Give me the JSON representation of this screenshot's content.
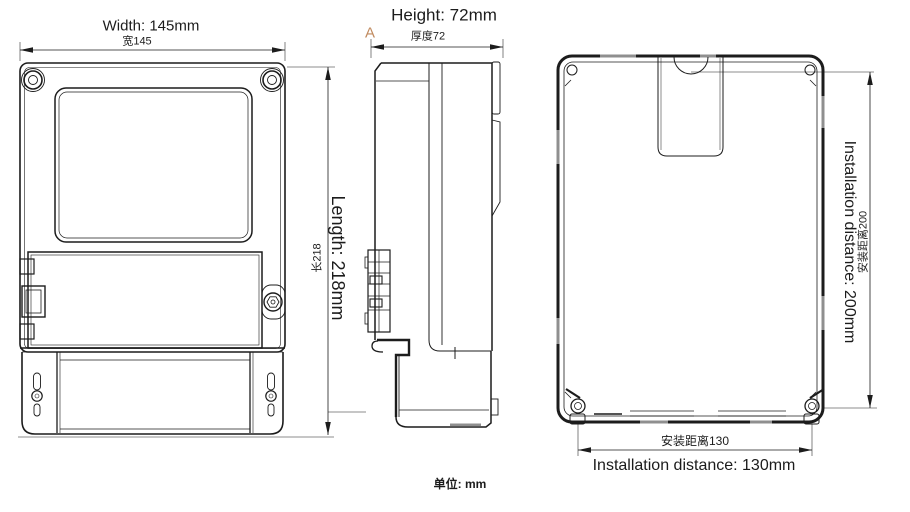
{
  "drawing": {
    "unit_note": "单位: mm",
    "front_view": {
      "width_dim_en": "Width: 145mm",
      "width_dim_cn": "宽145"
    },
    "side_view": {
      "height_dim_en": "Height: 72mm",
      "height_dim_cn": "厚度72",
      "length_dim_en": "Length: 218mm",
      "length_dim_cn": "长218",
      "section_marker": "A"
    },
    "back_view": {
      "vertical_dim_en": "Installation distance: 200mm",
      "vertical_dim_cn": "安装距离200",
      "horizontal_dim_en": "Installation distance: 130mm",
      "horizontal_dim_cn": "安装距离130"
    },
    "colors": {
      "line": "#1c1c1c",
      "section_marker": "#c08a5e",
      "gray_detail": "#8f8f8f"
    }
  }
}
